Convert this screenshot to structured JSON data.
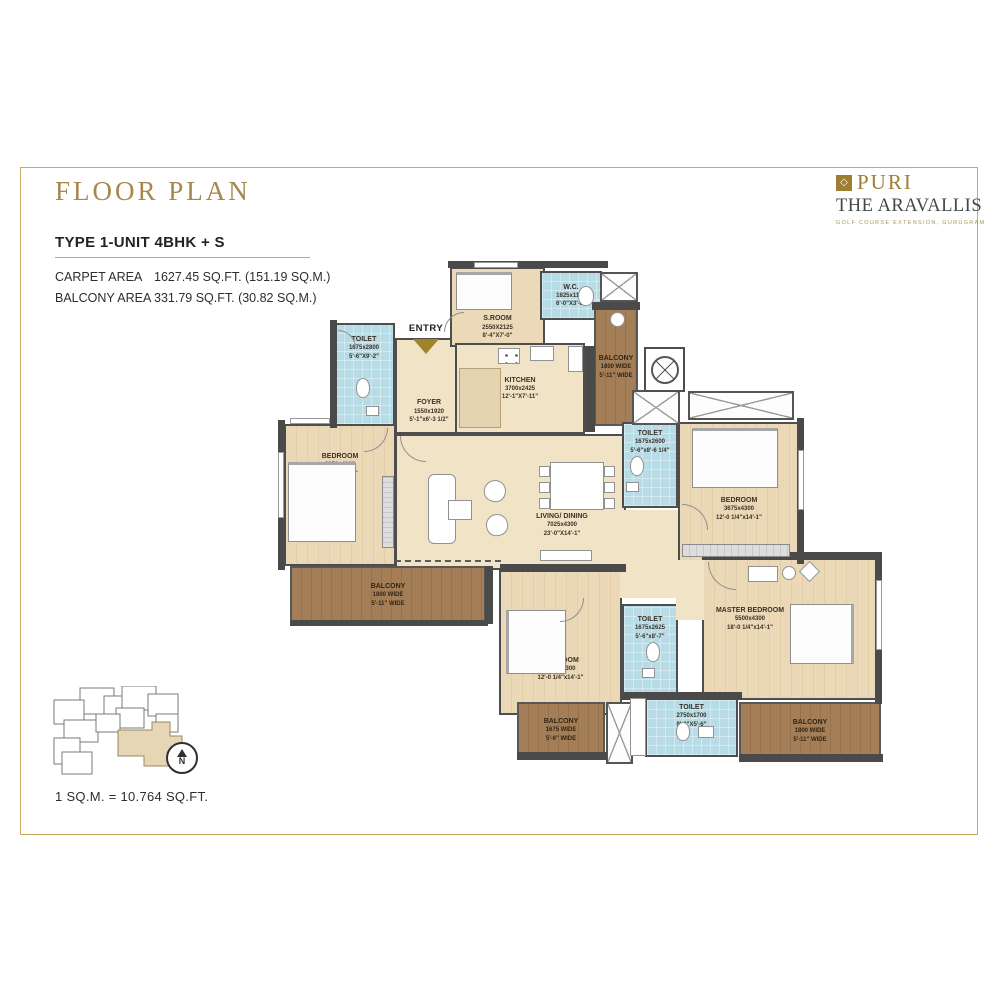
{
  "header": {
    "title": "FLOOR PLAN"
  },
  "brand": {
    "diamond_icon": "diamond",
    "name": "PURI",
    "subname": "THE ARAVALLIS",
    "tagline": "GOLF COURSE EXTENSION, GURUGRAM"
  },
  "unit": {
    "type": "TYPE 1-UNIT 4BHK + S",
    "carpet_label": "CARPET AREA",
    "carpet_value": "1627.45 SQ.FT. (151.19 SQ.M.)",
    "balcony_label": "BALCONY AREA",
    "balcony_value": "331.79 SQ.FT. (30.82 SQ.M.)"
  },
  "plan": {
    "entry_label": "ENTRY",
    "rooms": {
      "toilet_entry": {
        "name": "TOILET",
        "mm": "1675x2800",
        "ft": "5'-6\"X9'-2\""
      },
      "foyer": {
        "name": "FOYER",
        "mm": "1550x1920",
        "ft": "5'-1\"x6'-3 1/2\""
      },
      "servant_room": {
        "name": "S.ROOM",
        "mm": "2550X2125",
        "ft": "8'-4\"X7'-0\""
      },
      "wc": {
        "name": "W.C.",
        "mm": "1825x1125",
        "ft": "6'-0\"X3'-8\""
      },
      "kitchen": {
        "name": "KITCHEN",
        "mm": "3700x2425",
        "ft": "12'-1\"X7'-11\""
      },
      "balcony_top": {
        "name": "BALCONY",
        "mm": "1800 WIDE",
        "ft": "5'-11\" WIDE"
      },
      "bedroom_left": {
        "name": "BEDROOM",
        "mm": "3350x4300",
        "ft": "11'-0\"x14'-1\""
      },
      "living_dining": {
        "name": "LIVING/ DINING",
        "mm": "7025x4300",
        "ft": "23'-0\"X14'-1\""
      },
      "toilet_mid": {
        "name": "TOILET",
        "mm": "1675x2600",
        "ft": "5'-6\"x8'-6 1/4\""
      },
      "bedroom_right": {
        "name": "BEDROOM",
        "mm": "3675x4300",
        "ft": "12'-0 1/4\"x14'-1\""
      },
      "balcony_left": {
        "name": "BALCONY",
        "mm": "1800 WIDE",
        "ft": "5'-11\" WIDE"
      },
      "bedroom_bottom": {
        "name": "BEDROOM",
        "mm": "3675x4300",
        "ft": "12'-0 1/4\"x14'-1\""
      },
      "toilet_bottom": {
        "name": "TOILET",
        "mm": "1675x2625",
        "ft": "5'-6\"x8'-7\""
      },
      "master_bedroom": {
        "name": "MASTER BEDROOM",
        "mm": "5500x4300",
        "ft": "18'-0 1/4\"x14'-1\""
      },
      "toilet_master": {
        "name": "TOILET",
        "mm": "2750x1700",
        "ft": "9'-0\"X5'-6\""
      },
      "balcony_bottom_left": {
        "name": "BALCONY",
        "mm": "1675 WIDE",
        "ft": "5'-6\" WIDE"
      },
      "balcony_bottom_right": {
        "name": "BALCONY",
        "mm": "1800 WIDE",
        "ft": "5'-11\" WIDE"
      }
    }
  },
  "footer": {
    "scale_note": "1 SQ.M. = 10.764 SQ.FT.",
    "north_label": "N"
  },
  "colors": {
    "accent_gold": "#a6884e",
    "brand_gold": "#9d7f33",
    "toilet_blue": "#b7dce6",
    "room_beige": "#ecd9b8",
    "living_cream": "#f1e3c6",
    "balcony_brown": "#a47e57",
    "wall_dark": "#4a4a4a"
  }
}
